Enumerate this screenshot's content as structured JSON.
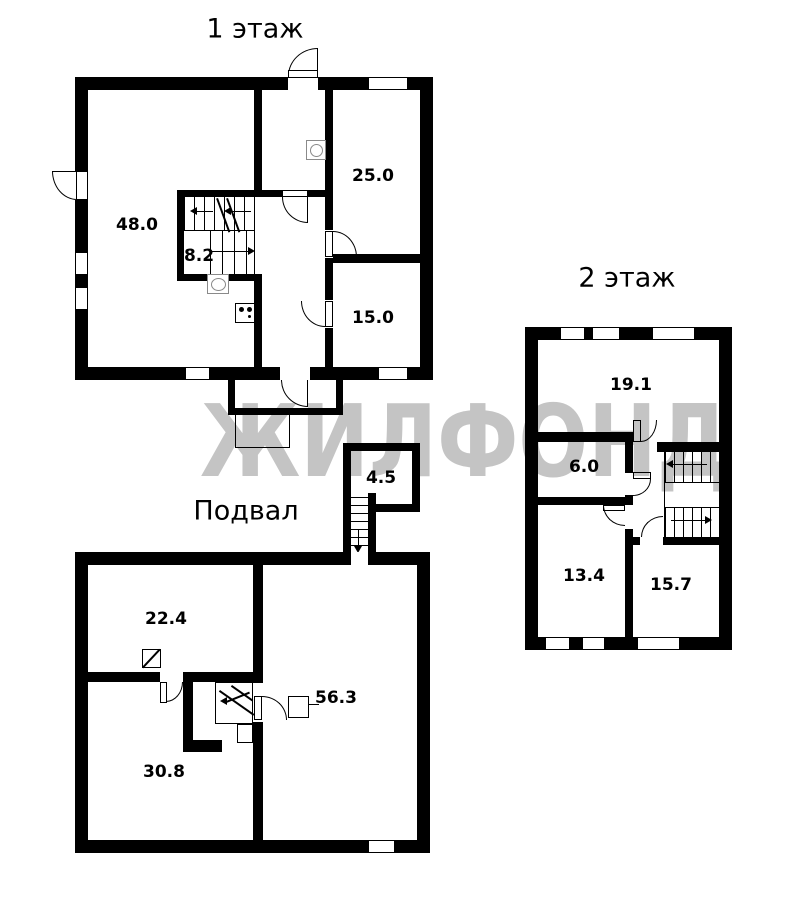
{
  "watermark": {
    "text": "ЖИЛФОНД",
    "color": "#c4c4c4"
  },
  "colors": {
    "wall": "#000000",
    "background": "#ffffff",
    "icon_gray": "#8a8a8a"
  },
  "icons": {
    "floor1": [
      "sink-icon",
      "stove-icon",
      "gas-meter-icon"
    ],
    "basement": [
      "vent-hatch-icon",
      "radiator-icon",
      "stair-flight-icon"
    ]
  },
  "floors": {
    "floor1": {
      "title": "1 этаж",
      "rooms": [
        {
          "name": "room-48",
          "area": "48.0"
        },
        {
          "name": "stair-hall",
          "area": "8.2"
        },
        {
          "name": "room-25",
          "area": "25.0"
        },
        {
          "name": "room-15",
          "area": "15.0"
        }
      ]
    },
    "floor2": {
      "title": "2 этаж",
      "rooms": [
        {
          "name": "room-19-1",
          "area": "19.1"
        },
        {
          "name": "room-6",
          "area": "6.0"
        },
        {
          "name": "room-13-4",
          "area": "13.4"
        },
        {
          "name": "room-15-7",
          "area": "15.7"
        }
      ]
    },
    "basement": {
      "title": "Подвал",
      "rooms": [
        {
          "name": "room-22-4",
          "area": "22.4"
        },
        {
          "name": "room-30-8",
          "area": "30.8"
        },
        {
          "name": "room-56-3",
          "area": "56.3"
        },
        {
          "name": "entry-4-5",
          "area": "4.5"
        }
      ]
    }
  }
}
